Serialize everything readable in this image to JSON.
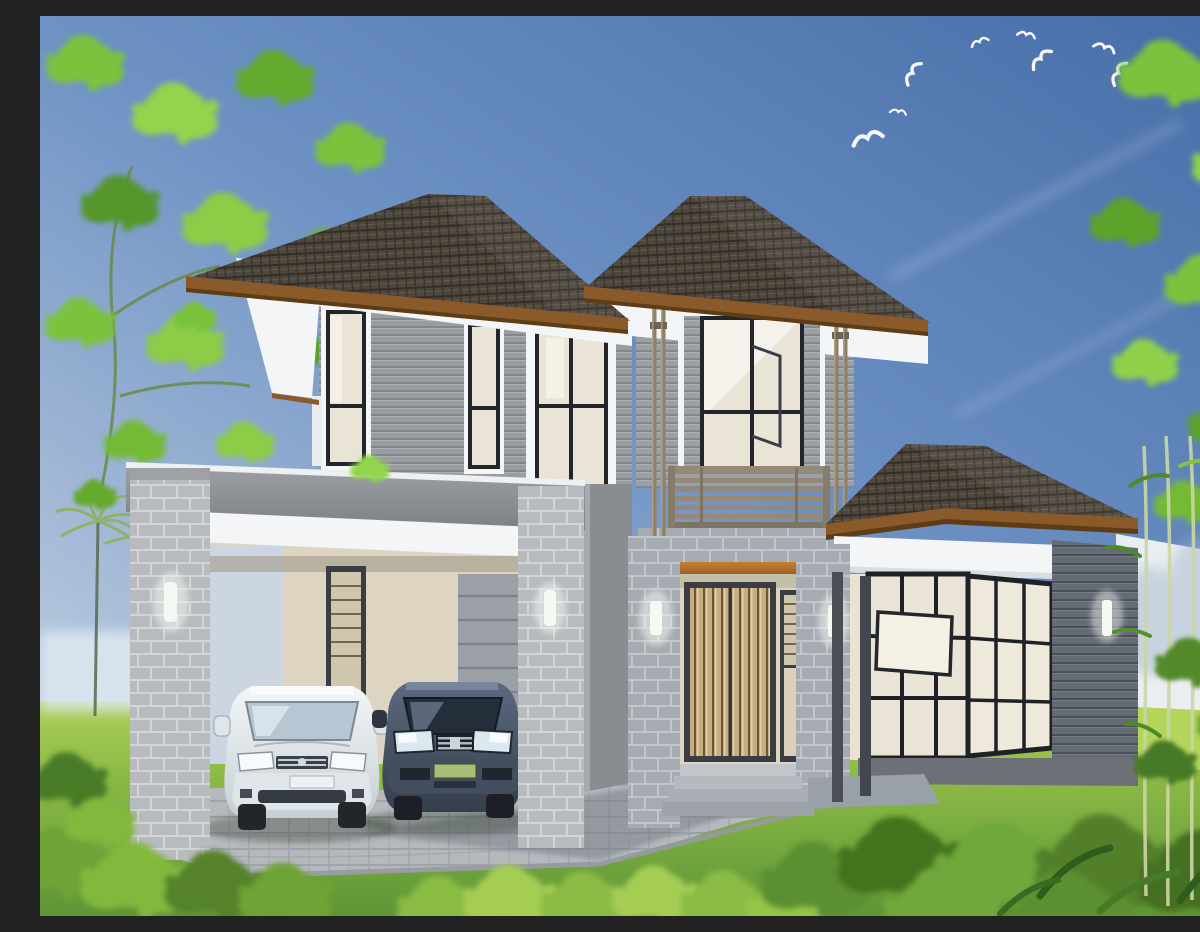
{
  "image": {
    "kind": "3D architectural exterior rendering",
    "subject": "Modern two-storey house with dark hip tile roofs, grey horizontal siding, white eaves, brick pillars, wood-slat entry door with balcony above, attached flat-roof carport sheltering two cars, single-storey glazed side pavilion, green lawn with shrubs, palm trees, leafy trees and a flock of white birds in a blue sky",
    "time_of_day": "daytime",
    "weather": "clear blue sky"
  },
  "inventory": {
    "storeys": 2,
    "cars": 2,
    "car_left_color": "white",
    "car_right_color": "dark grey-blue",
    "birds_in_sky": 8,
    "wall_lamps": 6,
    "roof": "dark grey concrete tiles with timber fascia trim",
    "balcony": "horizontal slat railing above the entry",
    "entry": "vertical wood-slat double door, sidelight window, concrete steps",
    "carport": "flat roof on light brick pillars over paved driveway",
    "landscaping": "lawn, low shrubs, palm trees at left, bamboo and leafy trees at right"
  },
  "palette": {
    "sky_top": "#466da8",
    "sky_mid": "#6e92c4",
    "sky_low": "#c6d2e2",
    "grass_far": "#abd058",
    "grass_mid": "#8cba46",
    "grass_near": "#5e9536",
    "roof_tile": "#4e473d",
    "roof_tile_dark": "#332f27",
    "roof_tile_light": "#6b6356",
    "fascia_wood": "#8a5a2a",
    "fascia_wood_dark": "#5e3c16",
    "eave_white": "#f3f5f6",
    "eave_shadow": "#d9dee3",
    "siding_light": "#989da2",
    "siding_tower": "#9aa0a6",
    "siding_dark": "#646b75",
    "brick_light": "#b7bbbe",
    "brick_mortar": "#d2d5d8",
    "brick_mid": "#a6abb1",
    "brick_mortar_mid": "#c1c6cb",
    "carport_band": "#8e9297",
    "interior_cream": "#ddd5c1",
    "door_wood": "#c6ad82",
    "frame_dark": "#3a3d42",
    "glass_cream": "#eae4d6",
    "glass_sky": "#b6c6d2",
    "balcony_rail": "#948a77",
    "beam_orange": "#b06f2a",
    "paving": "#b5b9be",
    "paving_shadow": "#8a8f96",
    "car_white": "#e8edf0",
    "car_dark": "#4b5668",
    "bush_light": "#8abb44",
    "bush_dark": "#4e7f26",
    "leaf_green": "#7cc23c",
    "fence_white": "#e9eef3",
    "lamp_glow": "#f6f8f4"
  }
}
